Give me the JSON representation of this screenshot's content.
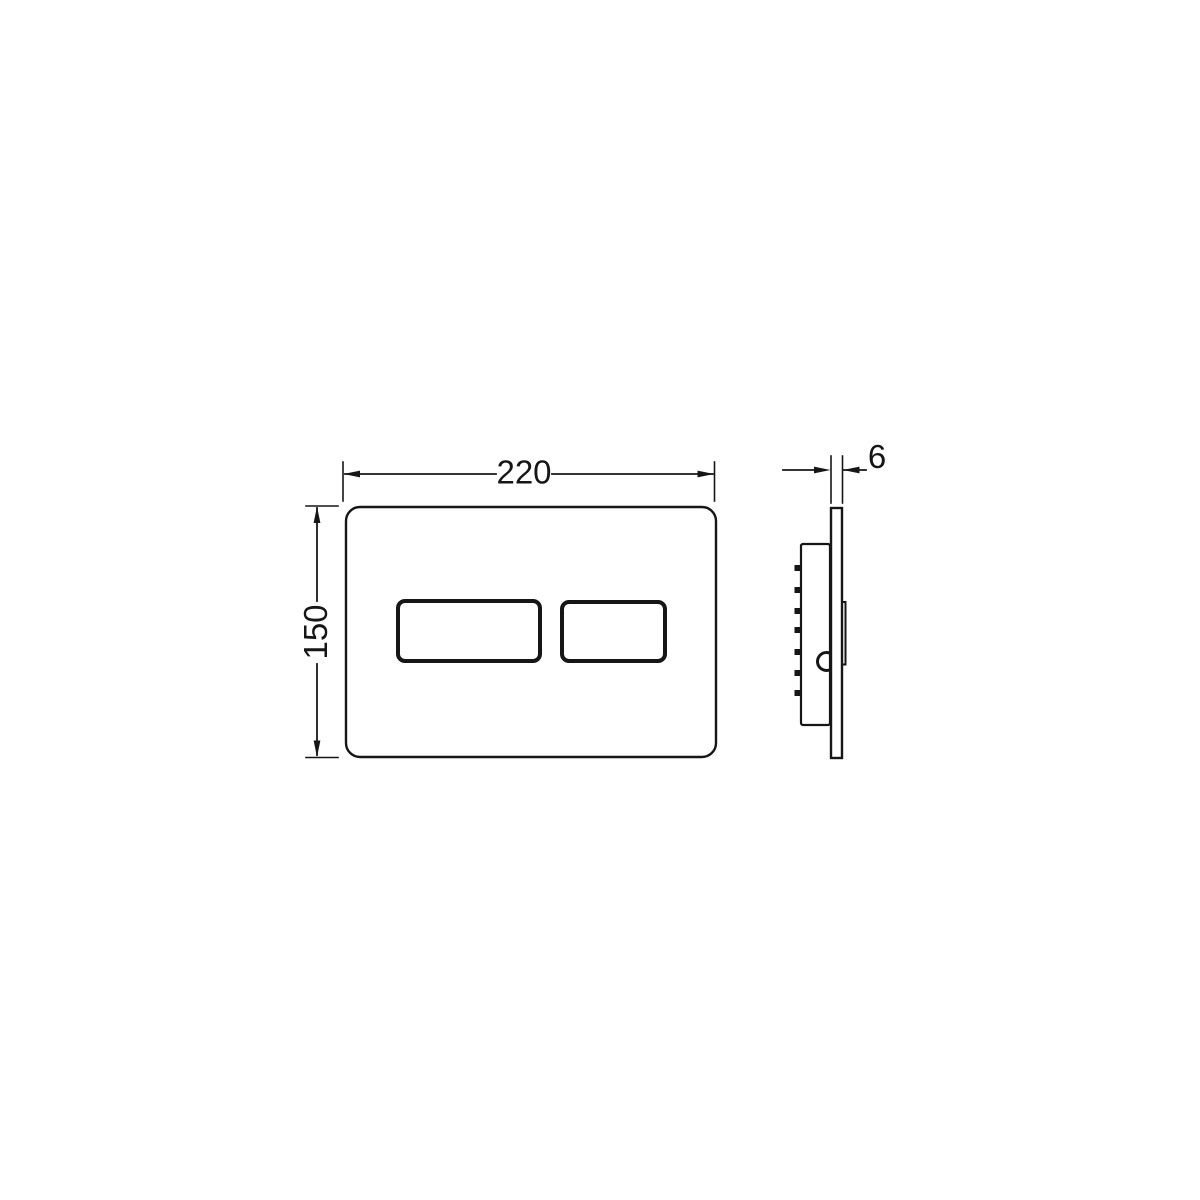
{
  "colors": {
    "line": "#161616",
    "background": "#ffffff"
  },
  "dimensions": {
    "width": "220",
    "height": "150",
    "depth": "6"
  }
}
